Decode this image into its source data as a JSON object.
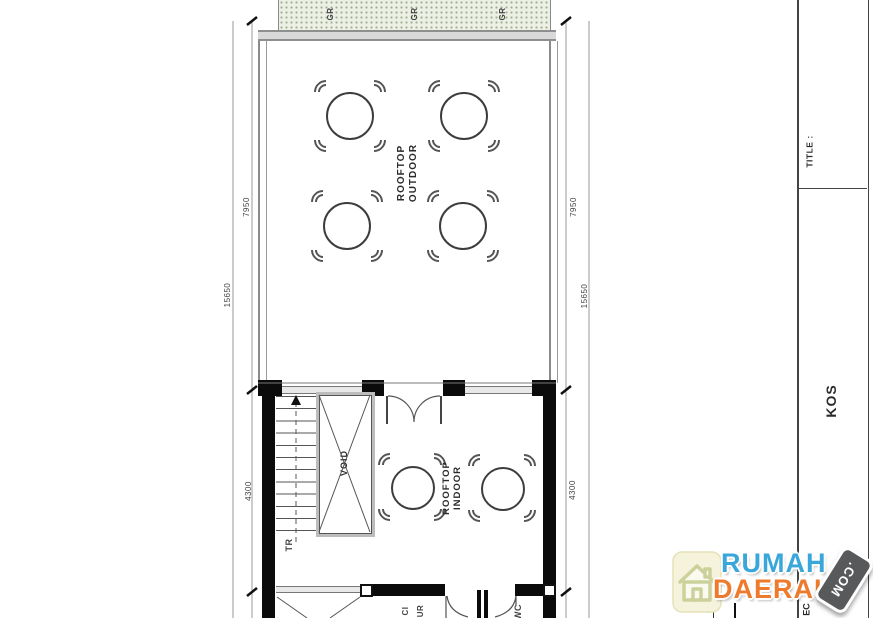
{
  "plan": {
    "grass_labels": [
      "GR",
      "GR",
      "GR"
    ],
    "rooms": {
      "outdoor_line1": "ROOFTOP",
      "outdoor_line2": "OUTDOOR",
      "indoor_line1": "ROOFTOP",
      "indoor_line2": "INDOOR",
      "void_label": "VOID",
      "stairs_label": "TR",
      "laundry_fragment_1": "CI",
      "laundry_fragment_2": "UR",
      "wc_fragment": "WC",
      "bottom_number_fragment": "4"
    },
    "dimensions": {
      "left_total": "15650",
      "left_upper": "7950",
      "left_lower": "4300",
      "right_total": "15650",
      "right_upper": "7950",
      "right_lower": "4300"
    }
  },
  "title_block": {
    "title_label": "TITLE :",
    "project_name": "KOS",
    "bottom_fragment": "EC"
  },
  "watermark": {
    "word1": "RUMAH",
    "word2": "DAERAH",
    "suffix": ".COM",
    "colors": {
      "word1": "#3aa7da",
      "word2": "#ee7b2d",
      "badge": "#58595b",
      "house_bg": "#f5f3dc",
      "house_stroke": "#ccd19c"
    }
  },
  "drawing_colors": {
    "planter_green": "#edf1e5",
    "wall_black": "#0b0b0b",
    "line_gray": "#8a8a8a"
  }
}
